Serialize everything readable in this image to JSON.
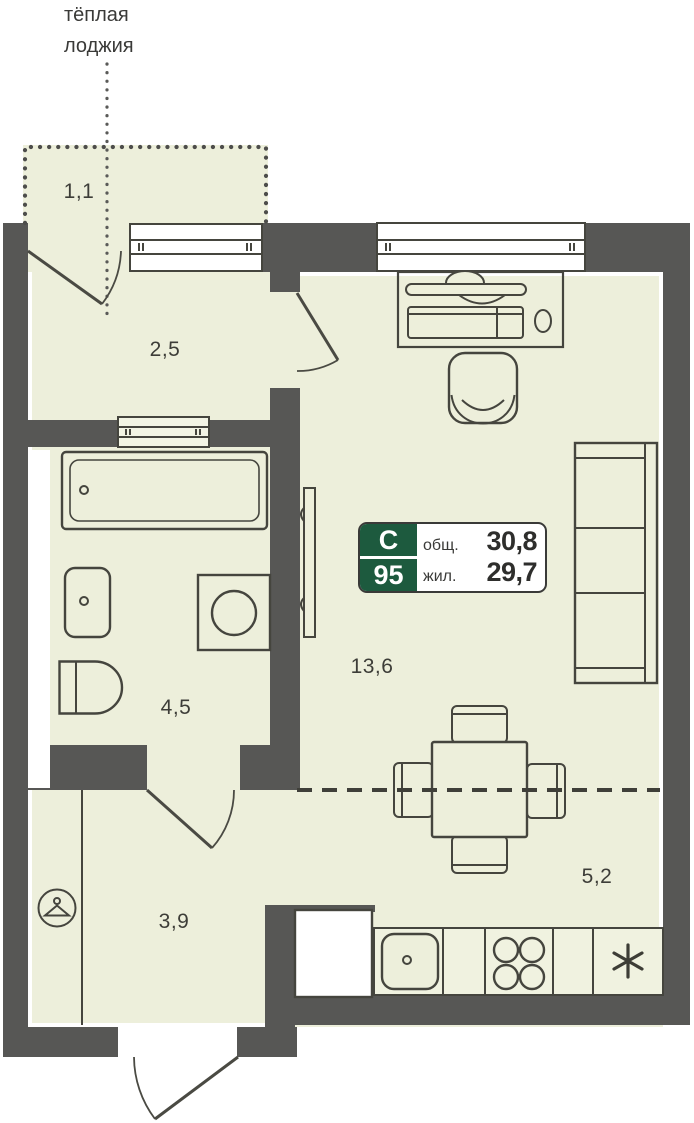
{
  "loggia_note": "тёплая лоджия",
  "areas": {
    "loggia": "1,1",
    "hallway": "2,5",
    "bathroom": "4,5",
    "living_room": "13,6",
    "kitchen": "5,2",
    "entry_hall": "3,9"
  },
  "info_badge": {
    "flat_type": "С",
    "flat_number": "95",
    "total_area_label": "общ.",
    "total_area": "30,8",
    "living_area_label": "жил.",
    "living_area": "29,7"
  },
  "colors": {
    "wall": "#575755",
    "floor": "#edefdb",
    "outline": "#45453e",
    "badge_green": "#1d5a3e",
    "text": "#3d3d38"
  }
}
